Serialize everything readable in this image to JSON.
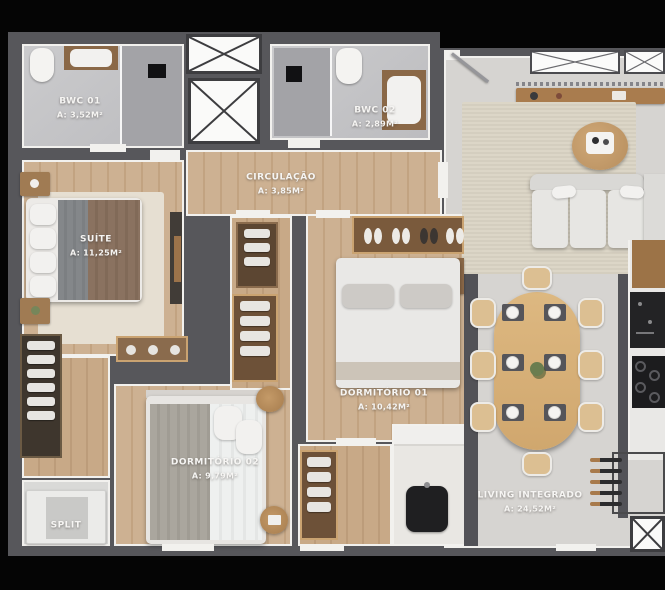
{
  "plan_title": "apartment-floor-plan",
  "colors": {
    "background": "#050505",
    "wall": "#57575b",
    "liner": "#f2f1ee",
    "wood_floor": "#c8ab8a",
    "tile_floor": "#c5c5c8",
    "living_floor": "#d6d4d1",
    "label_text": "#f6f5f3"
  },
  "rooms": [
    {
      "name": "BWC 01",
      "area": "A: 3,52M²"
    },
    {
      "name": "BWC 02",
      "area": "A: 2,89M²"
    },
    {
      "name": "CIRCULAÇÃO",
      "area": "A: 3,85M²"
    },
    {
      "name": "SUÍTE",
      "area": "A: 11,25M²"
    },
    {
      "name": "DORMITÓRIO 01",
      "area": "A: 10,42M²"
    },
    {
      "name": "DORMITÓRIO 02",
      "area": "A: 9,79M²"
    },
    {
      "name": "LIVING INTEGRADO",
      "area": "A: 24,52M²"
    },
    {
      "name": "SPLIT",
      "area": ""
    }
  ]
}
